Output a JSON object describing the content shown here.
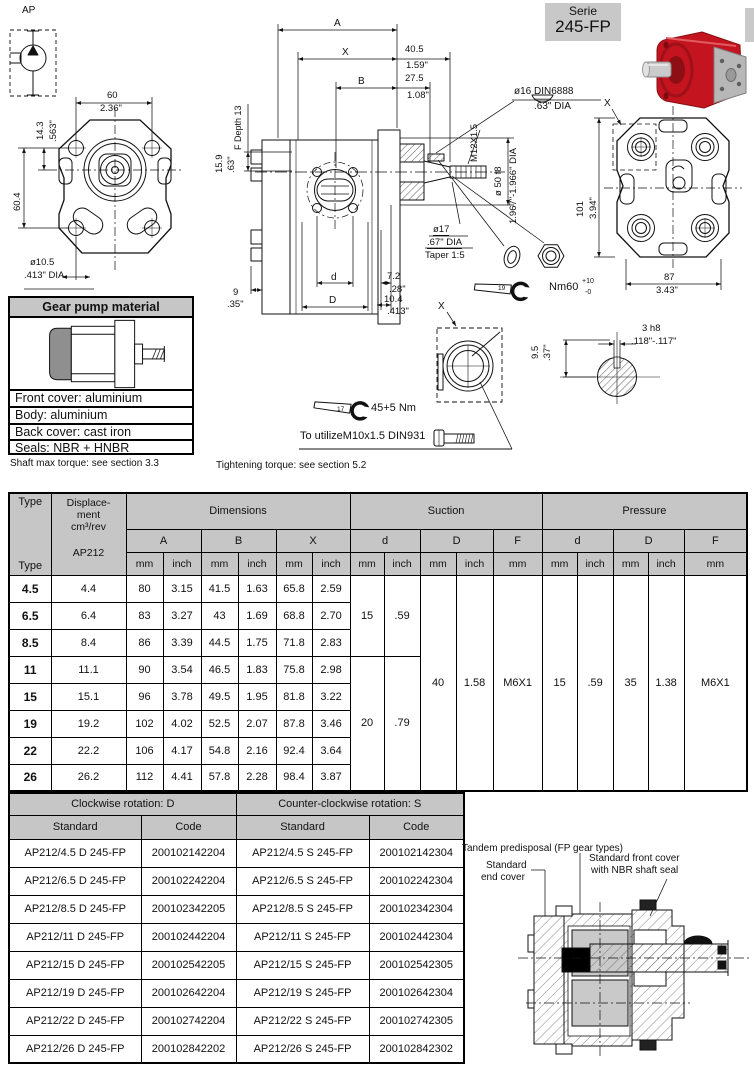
{
  "badge": {
    "line1": "Serie",
    "line2": "245-FP"
  },
  "ap_symbol": {
    "label": "AP"
  },
  "front_view": {
    "w_mm": "60",
    "w_in": "2.36\"",
    "offset_mm": "14.3",
    "offset_in": ".563\"",
    "h_mm": "60.4",
    "hole_mm": "ø10.5",
    "hole_in": ".413\" DIA"
  },
  "side_view": {
    "a": "A",
    "x": "X",
    "b": "B",
    "x2_mm": "40.5",
    "x2_in": "1.59\"",
    "b2_mm": "27.5",
    "b2_in": "1.08\"",
    "f_depth": "F Depth 13",
    "key_h_mm": "15.9",
    "key_h_in": ".63\"",
    "p9_mm": "9",
    "p9_in": ".35\"",
    "d_small": "d",
    "d_big": "D",
    "p72_mm": "7.2",
    "p72_in": ".28\"",
    "p104_mm": "10.4",
    "p104_in": ".413\"",
    "key": "ø16 DIN6888",
    "key_in": ".63\" DIA",
    "thread": "M12X1.5",
    "pilot": "ø 50 f8",
    "pilot_in": "1.967\"-1.966\" DIA",
    "shaft": "ø17",
    "shaft_in": ".67\" DIA",
    "taper": "Taper 1:5",
    "wrench": "19",
    "torque": "Nm60",
    "torque_sup": "+10",
    "torque_sub": "-0"
  },
  "rear_view": {
    "x": "X",
    "h_mm": "101",
    "h_in": "3.94\"",
    "w_mm": "87",
    "w_in": "3.43\""
  },
  "x_detail": {
    "x": "X",
    "wrench": "17",
    "torque": "45+5 Nm",
    "note": "To utilizeM10x1.5 DIN931"
  },
  "key_section": {
    "w": "3 h8",
    "w_in": ".118\"-.117\"",
    "h": "9.5",
    "h_in": ".37\""
  },
  "material": {
    "title": "Gear pump material",
    "rows": [
      "Front cover: aluminium",
      "Body: aluminium",
      "Back cover: cast iron",
      "Seals: NBR + HNBR"
    ]
  },
  "notes": {
    "shaft": "Shaft max torque: see section 3.3",
    "tightening": "Tightening torque: see section 5.2"
  },
  "dims_table": {
    "type_h": "Type",
    "disp_l1": "Displace-",
    "disp_l2": "ment",
    "disp_l3": "cm³/rev",
    "disp_l4": "AP212",
    "g_dim": "Dimensions",
    "g_suc": "Suction",
    "g_pre": "Pressure",
    "c_a": "A",
    "c_b": "B",
    "c_x": "X",
    "c_d": "d",
    "c_D": "D",
    "c_f": "F",
    "u_mm": "mm",
    "u_in": "inch",
    "rows": [
      {
        "type": "4.5",
        "disp": "4.4",
        "a_mm": "80",
        "a_in": "3.15",
        "b_mm": "41.5",
        "b_in": "1.63",
        "x_mm": "65.8",
        "x_in": "2.59"
      },
      {
        "type": "6.5",
        "disp": "6.4",
        "a_mm": "83",
        "a_in": "3.27",
        "b_mm": "43",
        "b_in": "1.69",
        "x_mm": "68.8",
        "x_in": "2.70"
      },
      {
        "type": "8.5",
        "disp": "8.4",
        "a_mm": "86",
        "a_in": "3.39",
        "b_mm": "44.5",
        "b_in": "1.75",
        "x_mm": "71.8",
        "x_in": "2.83"
      },
      {
        "type": "11",
        "disp": "11.1",
        "a_mm": "90",
        "a_in": "3.54",
        "b_mm": "46.5",
        "b_in": "1.83",
        "x_mm": "75.8",
        "x_in": "2.98"
      },
      {
        "type": "15",
        "disp": "15.1",
        "a_mm": "96",
        "a_in": "3.78",
        "b_mm": "49.5",
        "b_in": "1.95",
        "x_mm": "81.8",
        "x_in": "3.22"
      },
      {
        "type": "19",
        "disp": "19.2",
        "a_mm": "102",
        "a_in": "4.02",
        "b_mm": "52.5",
        "b_in": "2.07",
        "x_mm": "87.8",
        "x_in": "3.46"
      },
      {
        "type": "22",
        "disp": "22.2",
        "a_mm": "106",
        "a_in": "4.17",
        "b_mm": "54.8",
        "b_in": "2.16",
        "x_mm": "92.4",
        "x_in": "3.64"
      },
      {
        "type": "26",
        "disp": "26.2",
        "a_mm": "112",
        "a_in": "4.41",
        "b_mm": "57.8",
        "b_in": "2.28",
        "x_mm": "98.4",
        "x_in": "3.87"
      }
    ],
    "suction": {
      "d1_mm": "15",
      "d1_in": ".59",
      "d2_mm": "20",
      "d2_in": ".79",
      "D_mm": "40",
      "D_in": "1.58",
      "F": "M6X1"
    },
    "pressure": {
      "d_mm": "15",
      "d_in": ".59",
      "D_mm": "35",
      "D_in": "1.38",
      "F": "M6X1"
    }
  },
  "codes_table": {
    "cw": "Clockwise rotation: D",
    "ccw": "Counter-clockwise rotation: S",
    "standard": "Standard",
    "code": "Code",
    "rows": [
      {
        "cw_s": "AP212/4.5 D 245-FP",
        "cw_c": "200102142204",
        "ccw_s": "AP212/4.5 S 245-FP",
        "ccw_c": "200102142304"
      },
      {
        "cw_s": "AP212/6.5 D 245-FP",
        "cw_c": "200102242204",
        "ccw_s": "AP212/6.5 S 245-FP",
        "ccw_c": "200102242304"
      },
      {
        "cw_s": "AP212/8.5 D 245-FP",
        "cw_c": "200102342205",
        "ccw_s": "AP212/8.5 S 245-FP",
        "ccw_c": "200102342304"
      },
      {
        "cw_s": "AP212/11 D 245-FP",
        "cw_c": "200102442204",
        "ccw_s": "AP212/11 S 245-FP",
        "ccw_c": "200102442304"
      },
      {
        "cw_s": "AP212/15 D 245-FP",
        "cw_c": "200102542205",
        "ccw_s": "AP212/15 S 245-FP",
        "ccw_c": "200102542305"
      },
      {
        "cw_s": "AP212/19 D 245-FP",
        "cw_c": "200102642204",
        "ccw_s": "AP212/19 S 245-FP",
        "ccw_c": "200102642304"
      },
      {
        "cw_s": "AP212/22 D 245-FP",
        "cw_c": "200102742204",
        "ccw_s": "AP212/22 S 245-FP",
        "ccw_c": "200102742305"
      },
      {
        "cw_s": "AP212/26 D 245-FP",
        "cw_c": "200102842202",
        "ccw_s": "AP212/26 S 245-FP",
        "ccw_c": "200102842302"
      }
    ]
  },
  "tandem": {
    "l1": "Tandem predisposal (FP gear types)",
    "l2a": "Standard",
    "l2b": "end cover",
    "l3a": "Standard front cover",
    "l3b": "with NBR shaft seal"
  }
}
